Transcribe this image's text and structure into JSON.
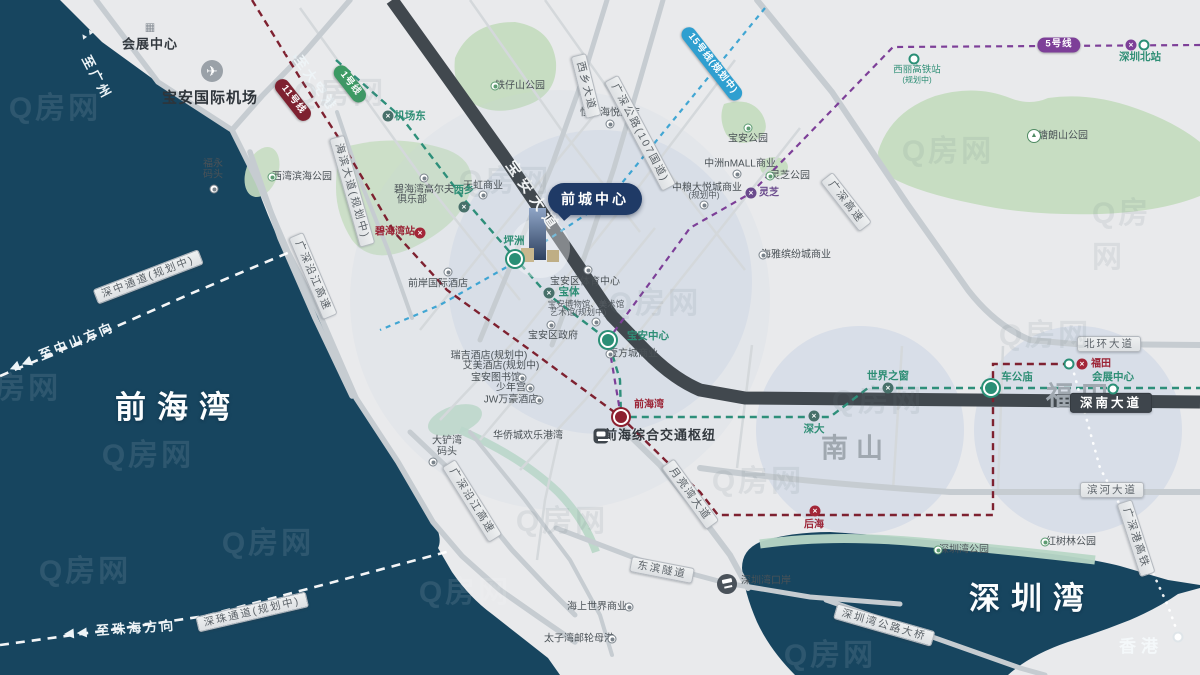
{
  "project": {
    "name": "前城中心"
  },
  "watermark_text": "Q房网",
  "colors": {
    "sea": "#17455f",
    "land": "#e9eaec",
    "park": "#c7ddc2",
    "shore": "#b8d7c6",
    "road": "#c7ccd1",
    "road_dark": "#41484e",
    "highlight": "#c7d2e3",
    "project_badge": "#1f3a66",
    "line1": "#2e8f7a",
    "line11": "#7e2130",
    "line5": "#7d3f98",
    "line15": "#2f9fd0"
  },
  "map": {
    "labels": [
      {
        "t": "会展中心",
        "x": 150,
        "y": 45,
        "k": "poi-b13"
      },
      {
        "t": "宝安国际机场",
        "x": 210,
        "y": 98,
        "k": "poi-b15"
      },
      {
        "t": "福永",
        "x": 213,
        "y": 164,
        "k": "poi"
      },
      {
        "t": "码头",
        "x": 213,
        "y": 175,
        "k": "poi"
      },
      {
        "t": "西湾滨海公园",
        "x": 302,
        "y": 177,
        "k": "poi"
      },
      {
        "t": "铁仔山公园",
        "x": 520,
        "y": 86,
        "k": "poi"
      },
      {
        "t": "恒丰海悦酒店",
        "x": 610,
        "y": 113,
        "k": "poi"
      },
      {
        "t": "宝安公园",
        "x": 748,
        "y": 139,
        "k": "poi"
      },
      {
        "t": "塘朗山公园",
        "x": 1063,
        "y": 136,
        "k": "poi"
      },
      {
        "t": "西丽高铁站",
        "x": 917,
        "y": 71,
        "k": "poi-green"
      },
      {
        "t": "(规划中)",
        "x": 917,
        "y": 80,
        "k": "poi-green-s"
      },
      {
        "t": "中洲nMALL商业",
        "x": 740,
        "y": 164,
        "k": "poi"
      },
      {
        "t": "灵芝公园",
        "x": 790,
        "y": 176,
        "k": "poi"
      },
      {
        "t": "中粮大悦城商业",
        "x": 707,
        "y": 188,
        "k": "poi"
      },
      {
        "t": "(规划中)",
        "x": 704,
        "y": 196,
        "k": "poi-s"
      },
      {
        "t": "海雅缤纷城商业",
        "x": 796,
        "y": 255,
        "k": "poi"
      },
      {
        "t": "天虹商业",
        "x": 483,
        "y": 186,
        "k": "poi"
      },
      {
        "t": "碧海湾高尔夫",
        "x": 424,
        "y": 190,
        "k": "poi"
      },
      {
        "t": "俱乐部",
        "x": 412,
        "y": 200,
        "k": "poi"
      },
      {
        "t": "前岸国际酒店",
        "x": 438,
        "y": 284,
        "k": "poi"
      },
      {
        "t": "瑞吉酒店(规划中)",
        "x": 489,
        "y": 356,
        "k": "poi"
      },
      {
        "t": "艾美酒店(规划中)",
        "x": 501,
        "y": 366,
        "k": "poi"
      },
      {
        "t": "宝安图书馆",
        "x": 496,
        "y": 378,
        "k": "poi"
      },
      {
        "t": "少年宫",
        "x": 511,
        "y": 388,
        "k": "poi"
      },
      {
        "t": "JW万豪酒店",
        "x": 511,
        "y": 400,
        "k": "poi"
      },
      {
        "t": "宝安区政府",
        "x": 553,
        "y": 336,
        "k": "poi"
      },
      {
        "t": "宝安区体育中心",
        "x": 585,
        "y": 282,
        "k": "poi"
      },
      {
        "t": "宝安博物馆、美术馆",
        "x": 586,
        "y": 305,
        "k": "poi-s"
      },
      {
        "t": "艺术馆(规划中)",
        "x": 578,
        "y": 313,
        "k": "poi-s"
      },
      {
        "t": "壹方城商业",
        "x": 633,
        "y": 354,
        "k": "poi"
      },
      {
        "t": "前海综合交通枢纽",
        "x": 660,
        "y": 436,
        "k": "poi-b13"
      },
      {
        "t": "华侨城欢乐港湾",
        "x": 528,
        "y": 436,
        "k": "poi"
      },
      {
        "t": "大铲湾",
        "x": 447,
        "y": 441,
        "k": "poi"
      },
      {
        "t": "码头",
        "x": 447,
        "y": 452,
        "k": "poi"
      },
      {
        "t": "海上世界商业",
        "x": 597,
        "y": 607,
        "k": "poi"
      },
      {
        "t": "太子湾邮轮母港",
        "x": 579,
        "y": 639,
        "k": "poi"
      },
      {
        "t": "深圳湾口岸",
        "x": 766,
        "y": 581,
        "k": "poi"
      },
      {
        "t": "深圳湾公园",
        "x": 964,
        "y": 550,
        "k": "poi"
      },
      {
        "t": "红树林公园",
        "x": 1071,
        "y": 542,
        "k": "poi"
      },
      {
        "t": "前海湾",
        "x": 178,
        "y": 408,
        "k": "sea-xl"
      },
      {
        "t": "深圳湾",
        "x": 1032,
        "y": 599,
        "k": "sea-xl"
      },
      {
        "t": "香港",
        "x": 1141,
        "y": 647,
        "k": "sea-lg"
      },
      {
        "t": "南山",
        "x": 856,
        "y": 449,
        "k": "region"
      },
      {
        "t": "福田",
        "x": 1081,
        "y": 397,
        "k": "region"
      },
      {
        "t": "◀◀ 至中山方向",
        "x": 62,
        "y": 348,
        "k": "dir",
        "rot": -22
      },
      {
        "t": "◀◀ 至珠海方向",
        "x": 120,
        "y": 630,
        "k": "dir",
        "rot": -4
      },
      {
        "t": "至广州",
        "x": 96,
        "y": 78,
        "k": "dir",
        "rot": 62
      },
      {
        "t": "至大空港",
        "x": 315,
        "y": 84,
        "k": "dir",
        "rot": 55
      },
      {
        "t": "▲▲",
        "x": 292,
        "y": 54,
        "k": "dir-s",
        "rot": 28
      },
      {
        "t": "▲▲",
        "x": 87,
        "y": 34,
        "k": "dir-s",
        "rot": -35
      }
    ],
    "road_labels": [
      {
        "t": "海滨大道(规划中)",
        "x": 352,
        "y": 191,
        "rot": 74
      },
      {
        "t": "广深沿江高速",
        "x": 313,
        "y": 276,
        "rot": 67
      },
      {
        "t": "广深沿江高速",
        "x": 472,
        "y": 501,
        "rot": 58
      },
      {
        "t": "西乡大道",
        "x": 586,
        "y": 86,
        "rot": 76
      },
      {
        "t": "广深公路(107国道)",
        "x": 640,
        "y": 133,
        "rot": 62
      },
      {
        "t": "广深高速",
        "x": 846,
        "y": 202,
        "rot": 52
      },
      {
        "t": "北环大道",
        "x": 1109,
        "y": 344,
        "rot": 0
      },
      {
        "t": "深南大道",
        "x": 1111,
        "y": 403,
        "rot": 0,
        "dark": true
      },
      {
        "t": "滨河大道",
        "x": 1112,
        "y": 490,
        "rot": 0
      },
      {
        "t": "月亮湾大道",
        "x": 690,
        "y": 494,
        "rot": 54
      },
      {
        "t": "东滨隧道",
        "x": 662,
        "y": 570,
        "rot": 11
      },
      {
        "t": "深圳湾公路大桥",
        "x": 884,
        "y": 625,
        "rot": 16
      },
      {
        "t": "深中通道(规划中)",
        "x": 148,
        "y": 277,
        "rot": -21
      },
      {
        "t": "深珠通道(规划中)",
        "x": 252,
        "y": 612,
        "rot": -13
      },
      {
        "t": "广深港高铁",
        "x": 1136,
        "y": 538,
        "rot": 72
      },
      {
        "t": "宝安大道",
        "x": 533,
        "y": 197,
        "rot": 55,
        "roadname": true
      }
    ],
    "line_badges": [
      {
        "t": "1号线",
        "x": 350,
        "y": 84,
        "rot": 52,
        "bg": "#3c9a63"
      },
      {
        "t": "11号线",
        "x": 293,
        "y": 100,
        "rot": 52,
        "bg": "#7e2130"
      },
      {
        "t": "15号线(规划中)",
        "x": 712,
        "y": 64,
        "rot": 52,
        "bg": "#2f9fd0"
      },
      {
        "t": "5号线",
        "x": 1059,
        "y": 45,
        "rot": 0,
        "bg": "#7d3f98"
      }
    ],
    "stations": [
      {
        "type": "major",
        "color": "#2a8f76",
        "x": 515,
        "y": 259,
        "label": "坪洲",
        "lx": 514,
        "ly": 241,
        "lk": "sta-green"
      },
      {
        "type": "major",
        "color": "#2a8f76",
        "x": 608,
        "y": 340,
        "label": "宝安中心",
        "lx": 648,
        "ly": 336,
        "lk": "sta-green"
      },
      {
        "type": "major",
        "color": "#2a8f76",
        "x": 991,
        "y": 388,
        "label": "车公庙",
        "lx": 1017,
        "ly": 377,
        "lk": "sta-green"
      },
      {
        "type": "major",
        "color": "#8d2030",
        "x": 621,
        "y": 417,
        "label": "前海湾",
        "lx": 649,
        "ly": 405,
        "lk": "sta-red"
      },
      {
        "type": "x",
        "color": "#47706a",
        "x": 388,
        "y": 116,
        "label": "机场东",
        "lx": 410,
        "ly": 116,
        "lk": "sta-green"
      },
      {
        "type": "x",
        "color": "#47706a",
        "x": 464,
        "y": 207,
        "label": "西乡",
        "lx": 464,
        "ly": 190,
        "lk": "sta-green"
      },
      {
        "type": "x",
        "color": "#47706a",
        "x": 549,
        "y": 293,
        "label": "宝体",
        "lx": 569,
        "ly": 292,
        "lk": "sta-green"
      },
      {
        "type": "x",
        "color": "#6a4a8c",
        "x": 751,
        "y": 193,
        "label": "灵芝",
        "lx": 769,
        "ly": 193,
        "lk": "sta-purple"
      },
      {
        "type": "x",
        "color": "#a32638",
        "x": 420,
        "y": 233,
        "label": "碧海湾站",
        "lx": 395,
        "ly": 232,
        "lk": "sta-red"
      },
      {
        "type": "x",
        "color": "#a32638",
        "x": 815,
        "y": 511,
        "label": "后海",
        "lx": 814,
        "ly": 525,
        "lk": "sta-red"
      },
      {
        "type": "ring",
        "color": "#2a8f76",
        "x": 1069,
        "y": 364
      },
      {
        "type": "x",
        "color": "#a32638",
        "x": 1082,
        "y": 364,
        "label": "福田",
        "lx": 1101,
        "ly": 364,
        "lk": "sta-red"
      },
      {
        "type": "x",
        "color": "#7d3f98",
        "x": 1131,
        "y": 45
      },
      {
        "type": "ring",
        "color": "#2a8f76",
        "x": 1144,
        "y": 45,
        "label": "深圳北站",
        "lx": 1140,
        "ly": 57,
        "lk": "sta-green"
      },
      {
        "type": "ring",
        "color": "#2a8f76",
        "x": 914,
        "y": 59
      },
      {
        "type": "ring",
        "color": "#2a8f76",
        "x": 1113,
        "y": 389,
        "label": "会展中心",
        "lx": 1113,
        "ly": 377,
        "lk": "sta-green"
      },
      {
        "type": "x",
        "color": "#47706a",
        "x": 888,
        "y": 388,
        "label": "世界之窗",
        "lx": 888,
        "ly": 376,
        "lk": "sta-green"
      },
      {
        "type": "x",
        "color": "#47706a",
        "x": 814,
        "y": 416,
        "label": "深大",
        "lx": 814,
        "ly": 429,
        "lk": "sta-green"
      },
      {
        "type": "ring",
        "color": "#dfe5e9",
        "x": 1178,
        "y": 637
      }
    ],
    "icons": [
      {
        "name": "building-icon",
        "type": "building",
        "x": 150,
        "y": 28
      },
      {
        "name": "airport-icon",
        "type": "airport",
        "x": 212,
        "y": 71
      },
      {
        "name": "ferry-pier-icon",
        "type": "poi",
        "x": 214,
        "y": 189
      },
      {
        "name": "park-icon",
        "type": "park",
        "x": 272,
        "y": 177
      },
      {
        "name": "park-icon",
        "type": "park",
        "x": 495,
        "y": 86
      },
      {
        "name": "hotel-icon",
        "type": "poi",
        "x": 610,
        "y": 124
      },
      {
        "name": "park-icon",
        "type": "park",
        "x": 748,
        "y": 128
      },
      {
        "name": "mountain-icon",
        "type": "mountain",
        "x": 1034,
        "y": 136
      },
      {
        "name": "mall-icon",
        "type": "poi",
        "x": 737,
        "y": 174
      },
      {
        "name": "park-icon",
        "type": "park",
        "x": 770,
        "y": 176
      },
      {
        "name": "mall-icon",
        "type": "poi",
        "x": 704,
        "y": 205
      },
      {
        "name": "mall-icon",
        "type": "poi",
        "x": 763,
        "y": 255
      },
      {
        "name": "mall-icon",
        "type": "poi",
        "x": 483,
        "y": 195
      },
      {
        "name": "golf-icon",
        "type": "poi",
        "x": 424,
        "y": 178
      },
      {
        "name": "hotel-icon",
        "type": "poi",
        "x": 448,
        "y": 272
      },
      {
        "name": "library-icon",
        "type": "poi",
        "x": 522,
        "y": 378
      },
      {
        "name": "youth-palace-icon",
        "type": "poi",
        "x": 530,
        "y": 388
      },
      {
        "name": "hotel-icon",
        "type": "poi",
        "x": 539,
        "y": 400
      },
      {
        "name": "government-icon",
        "type": "poi",
        "x": 551,
        "y": 325
      },
      {
        "name": "stadium-icon",
        "type": "poi",
        "x": 588,
        "y": 270
      },
      {
        "name": "museum-icon",
        "type": "poi",
        "x": 596,
        "y": 322
      },
      {
        "name": "mall-icon",
        "type": "poi",
        "x": 610,
        "y": 354
      },
      {
        "name": "train-hub-icon",
        "type": "train",
        "x": 601,
        "y": 436
      },
      {
        "name": "ferry-pier-icon",
        "type": "poi",
        "x": 433,
        "y": 462
      },
      {
        "name": "mall-icon",
        "type": "poi",
        "x": 629,
        "y": 607
      },
      {
        "name": "cruise-port-icon",
        "type": "poi",
        "x": 612,
        "y": 639
      },
      {
        "name": "border-port-icon",
        "type": "port",
        "x": 727,
        "y": 584
      },
      {
        "name": "park-icon",
        "type": "park",
        "x": 938,
        "y": 550
      },
      {
        "name": "park-icon",
        "type": "park",
        "x": 1045,
        "y": 542
      }
    ],
    "watermarks": [
      {
        "x": 55,
        "y": 105,
        "v": "sea"
      },
      {
        "x": 15,
        "y": 385,
        "v": "sea"
      },
      {
        "x": 148,
        "y": 452,
        "v": "sea"
      },
      {
        "x": 85,
        "y": 568,
        "v": "sea"
      },
      {
        "x": 268,
        "y": 540,
        "v": "sea"
      },
      {
        "x": 465,
        "y": 589,
        "v": "sea"
      },
      {
        "x": 830,
        "y": 652,
        "v": "sea"
      },
      {
        "x": 505,
        "y": 178,
        "v": "land"
      },
      {
        "x": 655,
        "y": 300,
        "v": "land"
      },
      {
        "x": 878,
        "y": 398,
        "v": "land"
      },
      {
        "x": 1045,
        "y": 332,
        "v": "land"
      },
      {
        "x": 948,
        "y": 148,
        "v": "land"
      },
      {
        "x": 758,
        "y": 478,
        "v": "land"
      },
      {
        "x": 1128,
        "y": 232,
        "v": "land"
      },
      {
        "x": 562,
        "y": 518,
        "v": "land"
      },
      {
        "x": 340,
        "y": 90,
        "v": "land"
      }
    ]
  }
}
